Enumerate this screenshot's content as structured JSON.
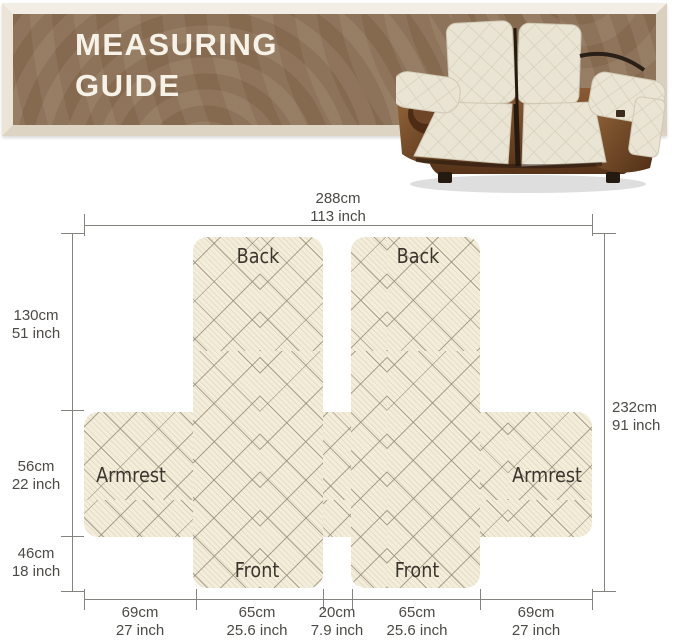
{
  "header": {
    "title_line1": "MEASURING",
    "title_line2": "GUIDE"
  },
  "diagram": {
    "panels": {
      "back_left": "Back",
      "back_right": "Back",
      "armrest_left": "Armrest",
      "armrest_right": "Armrest",
      "front_left": "Front",
      "front_right": "Front"
    },
    "dims": {
      "top": {
        "cm": "288cm",
        "inch": "113 inch"
      },
      "right": {
        "cm": "232cm",
        "inch": "91 inch"
      },
      "left": [
        {
          "cm": "130cm",
          "inch": "51 inch"
        },
        {
          "cm": "56cm",
          "inch": "22 inch"
        },
        {
          "cm": "46cm",
          "inch": "18 inch"
        }
      ],
      "bottom": [
        {
          "cm": "69cm",
          "inch": "27 inch"
        },
        {
          "cm": "65cm",
          "inch": "25.6 inch"
        },
        {
          "cm": "20cm",
          "inch": "7.9 inch"
        },
        {
          "cm": "65cm",
          "inch": "25.6 inch"
        },
        {
          "cm": "69cm",
          "inch": "27 inch"
        }
      ]
    }
  },
  "colors": {
    "banner_brown": "#8d7156",
    "frame_cream": "#eae2d5",
    "title_text": "#f6f2e7",
    "fabric_cream": "#f3edda",
    "quilt_line": "#968a76",
    "dim_line": "#85837e",
    "dim_text": "#4c4a45",
    "leather_brown": "#6e4526"
  }
}
